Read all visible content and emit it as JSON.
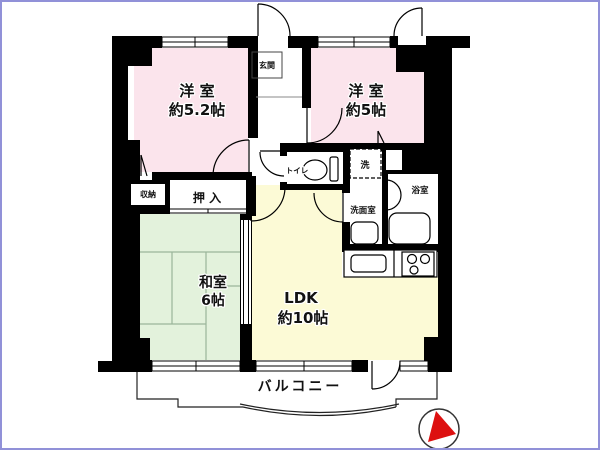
{
  "floorplan": {
    "type": "Japanese apartment floor plan",
    "colors": {
      "wall": "#000000",
      "western_room": "#fbe4ec",
      "japanese_room": "#e3f2dc",
      "ldk": "#fcfad6",
      "compass_red": "#dd1010",
      "frame": "#9191d8"
    },
    "rooms": {
      "western_room_1": {
        "name": "洋 室",
        "size": "約5.2帖"
      },
      "western_room_2": {
        "name": "洋 室",
        "size": "約5帖"
      },
      "japanese_room": {
        "name": "和室",
        "size": "6帖"
      },
      "ldk": {
        "name": "LDK",
        "size": "約10帖"
      },
      "entrance": {
        "name": "玄関"
      },
      "toilet": {
        "name": "トイレ"
      },
      "bathroom": {
        "name": "浴室"
      },
      "washroom": {
        "name": "洗面室"
      },
      "laundry": {
        "name": "洗"
      },
      "closet": {
        "name": "押 入"
      },
      "storage": {
        "name": "収納"
      },
      "balcony": {
        "name": "バルコニー"
      }
    }
  }
}
